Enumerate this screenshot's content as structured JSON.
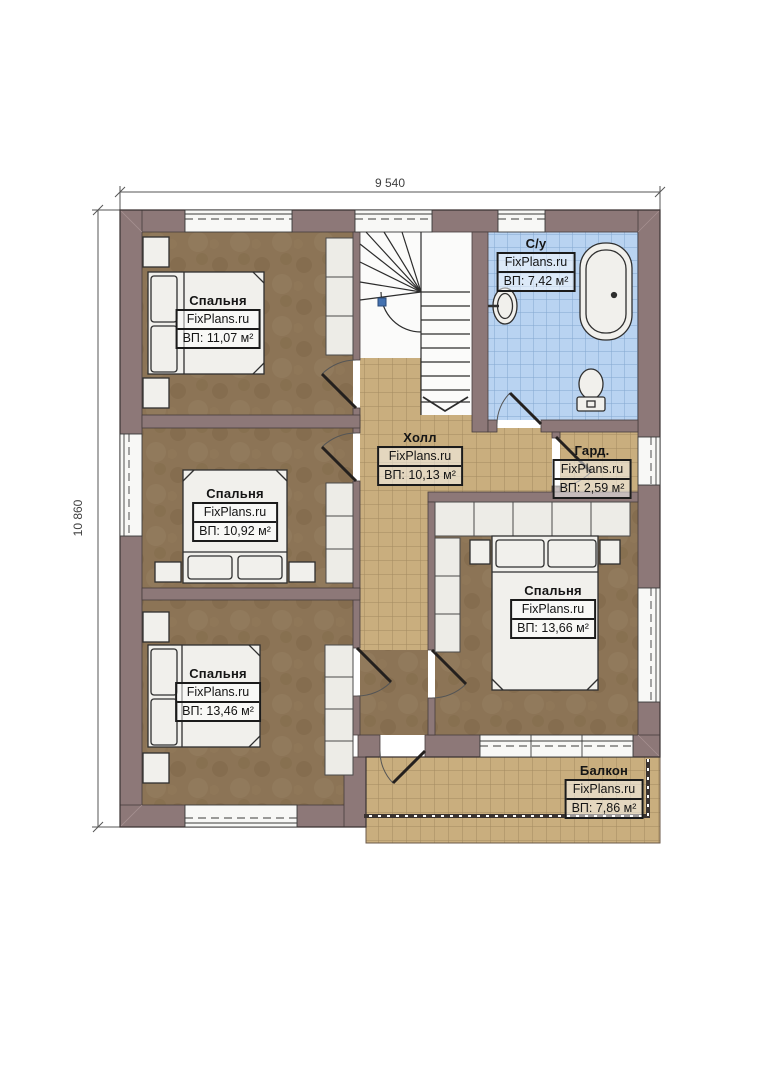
{
  "plan": {
    "type": "floor-plan",
    "dimensions": {
      "top": "9 540",
      "left": "10 860"
    },
    "rooms": [
      {
        "id": "bedroom-top-left",
        "name": "Спальня",
        "brand": "FixPlans.ru",
        "area": "ВП: 11,07 м²"
      },
      {
        "id": "bathroom",
        "name": "С/у",
        "brand": "FixPlans.ru",
        "area": "ВП: 7,42 м²"
      },
      {
        "id": "hall",
        "name": "Холл",
        "brand": "FixPlans.ru",
        "area": "ВП: 10,13 м²"
      },
      {
        "id": "wardrobe",
        "name": "Гард.",
        "brand": "FixPlans.ru",
        "area": "ВП: 2,59 м²"
      },
      {
        "id": "bedroom-mid-left",
        "name": "Спальня",
        "brand": "FixPlans.ru",
        "area": "ВП: 10,92 м²"
      },
      {
        "id": "bedroom-bot-left",
        "name": "Спальня",
        "brand": "FixPlans.ru",
        "area": "ВП: 13,46 м²"
      },
      {
        "id": "bedroom-right",
        "name": "Спальня",
        "brand": "FixPlans.ru",
        "area": "ВП: 13,66 м²"
      },
      {
        "id": "balcony",
        "name": "Балкон",
        "brand": "FixPlans.ru",
        "area": "ВП: 7,86 м²"
      }
    ],
    "colors": {
      "wall": "#8d7878",
      "bedroom_floor": "#8c7456",
      "tile_tan": "#c9ae7e",
      "tile_blue": "#b9d3f1",
      "furniture": "#f1f0ec",
      "outline": "#3a3232"
    }
  }
}
